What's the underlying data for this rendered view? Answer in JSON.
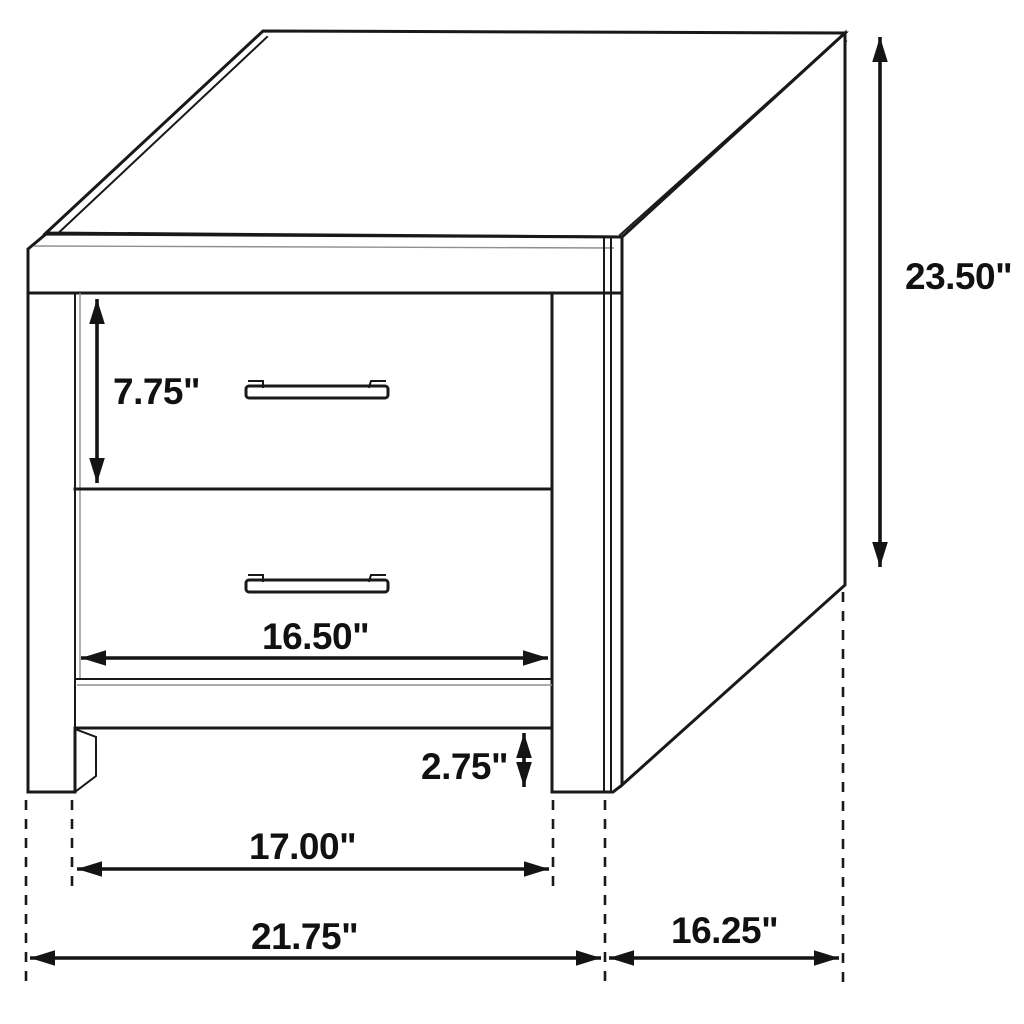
{
  "diagram": {
    "subject": "two-drawer nightstand line drawing",
    "colors": {
      "line": "#191919",
      "background": "#ffffff",
      "text": "#111111"
    },
    "labels": {
      "drawer_height": "7.75\"",
      "overall_height": "23.50\"",
      "drawer_width": "16.50\"",
      "leg_height": "2.75\"",
      "opening_width": "17.00\"",
      "overall_width": "21.75\"",
      "depth": "16.25\""
    }
  }
}
